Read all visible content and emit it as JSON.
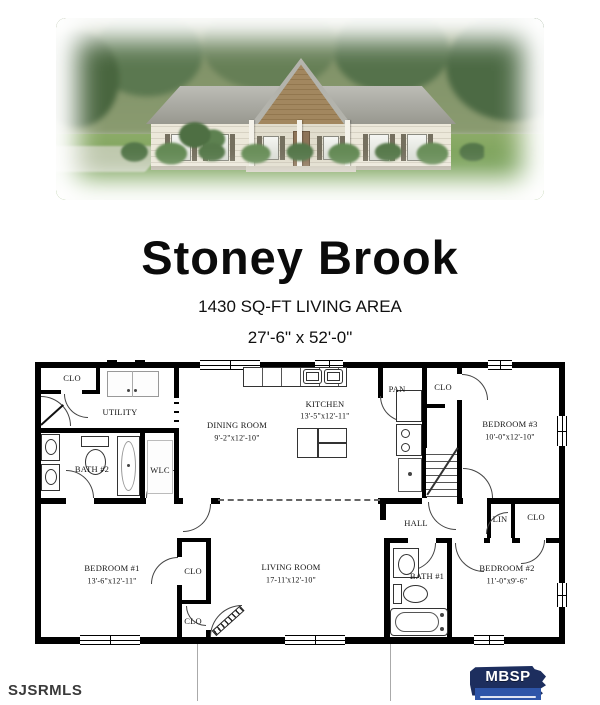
{
  "header": {
    "title": "Stoney Brook",
    "living_area": "1430 SQ-FT LIVING AREA",
    "overall_dims": "27'-6\" x 52'-0\""
  },
  "photo": {
    "description": "house-exterior-rendering",
    "colors": {
      "roof": "#9b9b93",
      "gable": "#a2875f",
      "siding": "#ece8da",
      "lawn": "#7aa25a",
      "trees": "#55724b"
    }
  },
  "floorplan": {
    "rooms": [
      {
        "id": "clo-utility",
        "label": "CLO"
      },
      {
        "id": "utility",
        "label": "UTILITY"
      },
      {
        "id": "bath-2",
        "label": "BATH #2"
      },
      {
        "id": "wlc",
        "label": "WLC"
      },
      {
        "id": "dining-room",
        "label": "DINING ROOM",
        "dims": "9'-2\"x12'-10\""
      },
      {
        "id": "kitchen",
        "label": "KITCHEN",
        "dims": "13'-5\"x12'-11\""
      },
      {
        "id": "pantry",
        "label": "PAN"
      },
      {
        "id": "clo-bedroom3",
        "label": "CLO"
      },
      {
        "id": "bedroom-3",
        "label": "BEDROOM #3",
        "dims": "10'-0\"x12'-10\""
      },
      {
        "id": "hall",
        "label": "HALL"
      },
      {
        "id": "linen",
        "label": "LIN"
      },
      {
        "id": "clo-linen",
        "label": "CLO"
      },
      {
        "id": "bedroom-1",
        "label": "BEDROOM #1",
        "dims": "13'-6\"x12'-11\""
      },
      {
        "id": "clo-bedroom1-upper",
        "label": "CLO"
      },
      {
        "id": "clo-bedroom1-lower",
        "label": "CLO"
      },
      {
        "id": "living-room",
        "label": "LIVING ROOM",
        "dims": "17-11'x12'-10\""
      },
      {
        "id": "bath-1",
        "label": "BATH #1"
      },
      {
        "id": "bedroom-2",
        "label": "BEDROOM #2",
        "dims": "11'-0\"x9'-6\""
      }
    ]
  },
  "footer": {
    "watermark": "SJSRMLS",
    "logo": {
      "name": "mbsp-logo",
      "text": "MBSP",
      "bg_hex": "#1d2e5e",
      "band_hex": "#2e55a8"
    }
  }
}
